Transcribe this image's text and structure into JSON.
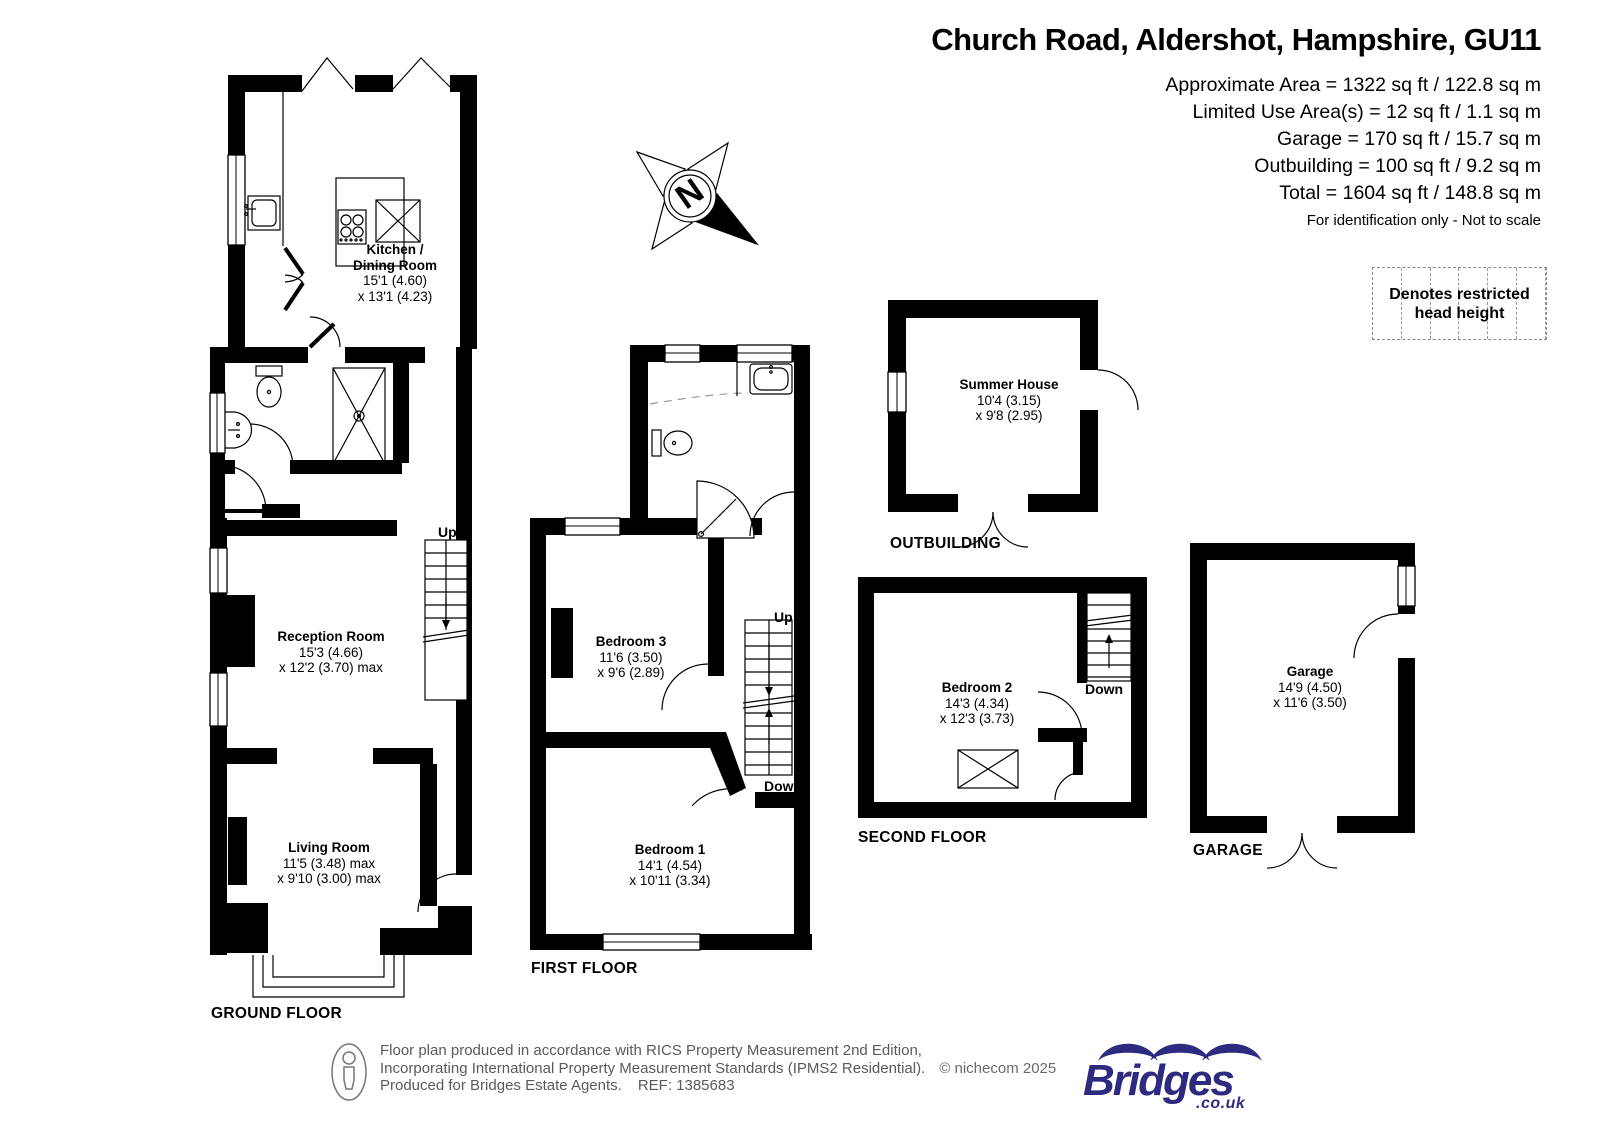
{
  "header": {
    "title": "Church Road, Aldershot, Hampshire, GU11",
    "areas": [
      "Approximate Area = 1322 sq ft / 122.8 sq m",
      "Limited Use Area(s) = 12 sq ft / 1.1 sq m",
      "Garage = 170 sq ft / 15.7 sq m",
      "Outbuilding = 100 sq ft / 9.2 sq m",
      "Total = 1604 sq ft / 148.8 sq m"
    ],
    "disclaimer": "For identification only - Not to scale"
  },
  "legend": {
    "line1": "Denotes restricted",
    "line2": "head height"
  },
  "compass": {
    "north": "N"
  },
  "rooms": {
    "kitchen": {
      "name1": "Kitchen /",
      "name2": "Dining Room",
      "dim1": "15'1 (4.60)",
      "dim2": "x 13'1 (4.23)"
    },
    "reception": {
      "name": "Reception Room",
      "dim1": "15'3 (4.66)",
      "dim2": "x 12'2 (3.70) max"
    },
    "living": {
      "name": "Living Room",
      "dim1": "11'5 (3.48) max",
      "dim2": "x 9'10 (3.00) max"
    },
    "bedroom3": {
      "name": "Bedroom 3",
      "dim1": "11'6 (3.50)",
      "dim2": "x 9'6 (2.89)"
    },
    "bedroom1": {
      "name": "Bedroom 1",
      "dim1": "14'1 (4.54)",
      "dim2": "x 10'11 (3.34)"
    },
    "bedroom2": {
      "name": "Bedroom 2",
      "dim1": "14'3 (4.34)",
      "dim2": "x 12'3 (3.73)"
    },
    "summer_house": {
      "name": "Summer House",
      "dim1": "10'4 (3.15)",
      "dim2": "x 9'8 (2.95)"
    },
    "garage": {
      "name": "Garage",
      "dim1": "14'9 (4.50)",
      "dim2": "x 11'6 (3.50)"
    }
  },
  "floor_labels": {
    "ground": "GROUND FLOOR",
    "first": "FIRST FLOOR",
    "second": "SECOND FLOOR",
    "outbuilding": "OUTBUILDING",
    "garage": "GARAGE"
  },
  "stairs": {
    "ground_up": "Up",
    "first_up": "Up",
    "first_down": "Down",
    "second_down": "Down"
  },
  "footer": {
    "line1": "Floor plan produced in accordance with RICS Property Measurement 2nd Edition,",
    "line2": "Incorporating International Property Measurement Standards (IPMS2 Residential).",
    "copyright": "© nichecom 2025",
    "line3": "Produced for Bridges Estate Agents.",
    "ref": "REF: 1385683"
  },
  "logo": {
    "brand": "Bridges",
    "domain": ".co.uk"
  },
  "colors": {
    "wall": "#000000",
    "logo_navy": "#2e2a80",
    "footer_text": "#5a5a5a"
  }
}
